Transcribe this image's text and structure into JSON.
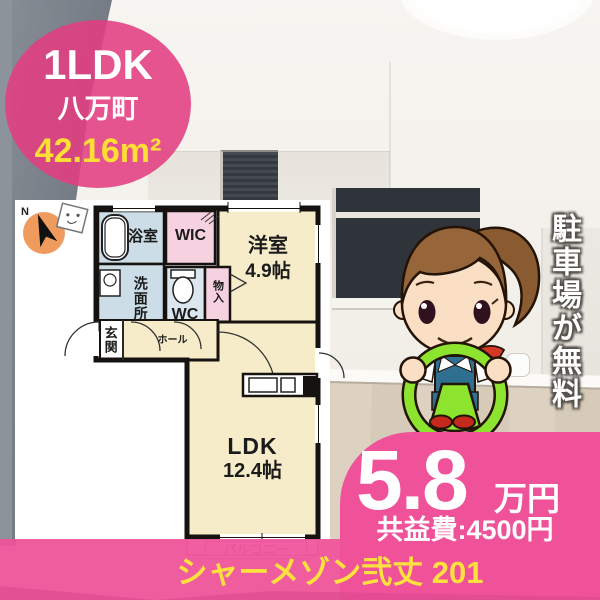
{
  "badge": {
    "layout_type": "1LDK",
    "location": "八万町",
    "area": "42.16m²"
  },
  "floorplan": {
    "compass_label": "N",
    "rooms": {
      "bath": "浴室",
      "wic": "WIC",
      "western_room": "洋室",
      "western_room_size": "4.9帖",
      "washroom": "洗面所",
      "toilet": "WC",
      "storage": "物入",
      "entrance": "玄関",
      "hall": "ホール",
      "ldk": "LDK",
      "ldk_size": "12.4帖",
      "balcony": "バルコニー"
    }
  },
  "side_banner": {
    "text": "駐車場が無料"
  },
  "price": {
    "rent": "5.8",
    "unit": "万円",
    "common_fee": "共益費:4500円"
  },
  "footer": {
    "building_name": "シャーメゾン弐丈 201"
  },
  "colors": {
    "accent_pink": "#f0529a",
    "highlight_yellow": "#ffdf35",
    "cream_room": "#f7ecca",
    "blue_room": "#ccdde7",
    "pink_room": "#f6d2e1",
    "wheel_green": "#8de42f",
    "compass_orange": "#ef9b5d"
  }
}
